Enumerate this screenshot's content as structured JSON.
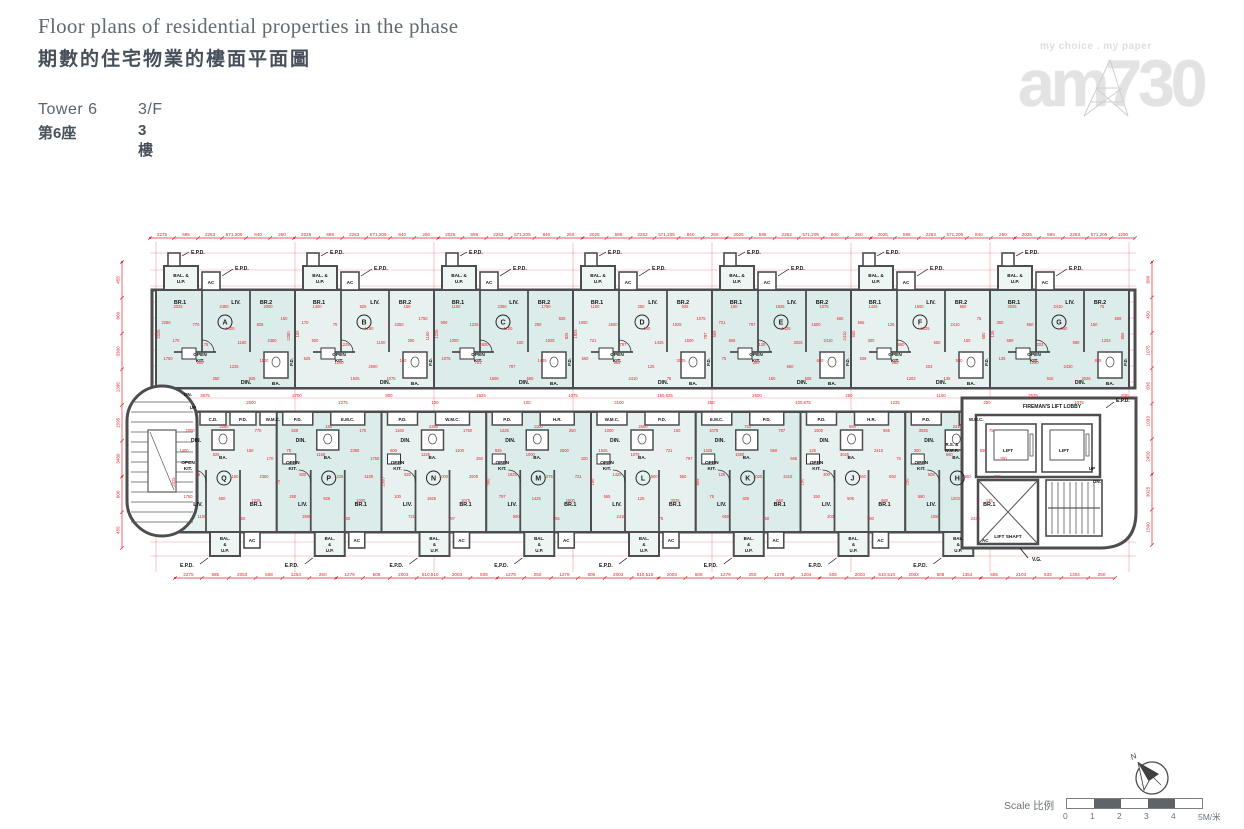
{
  "header": {
    "title_en": "Floor plans of residential properties in the phase",
    "title_zh": "期數的住宅物業的樓面平面圖",
    "tower_en": "Tower 6",
    "tower_zh": "第6座",
    "floor_en": "3/F",
    "floor_zh": "3樓"
  },
  "logo": {
    "tagline": "my choice . my paper",
    "brand": "am730"
  },
  "scale_bar": {
    "label": "Scale 比例",
    "ticks": [
      "0",
      "1",
      "2",
      "3",
      "4",
      "5M/米"
    ]
  },
  "compass": {
    "north": "N"
  },
  "colors": {
    "dim_red": "#e8232d",
    "wall": "#4d4d50",
    "room_fill": "#dcecea",
    "room_fill_alt": "#e7f2f0",
    "balcony_fill": "#eef6f4",
    "ink": "#141414",
    "tread": "#5a5a5c",
    "scale_dark": "#5f6468"
  },
  "plan": {
    "top_units": [
      "A",
      "B",
      "C",
      "D",
      "E",
      "F",
      "G"
    ],
    "bottom_units": [
      "Q",
      "P",
      "N",
      "M",
      "L",
      "K",
      "J",
      "H"
    ],
    "room_labels": {
      "br1": "BR.1",
      "br2": "BR.2",
      "liv": "LIV.",
      "din": "DIN.",
      "kit1": "OPEN",
      "kit2": "KIT.",
      "ba": "BA.",
      "bal1": "BAL. &",
      "bal2": "U.P.",
      "bal_s1": "BAL.",
      "bal_s2": "&",
      "bal_s3": "U.P.",
      "ac": "AC",
      "epd": "E.P.D.",
      "pd": "P.D."
    },
    "service_labels": {
      "cd": "C.D.",
      "wmc": "W.M.C.",
      "emc": "E.M.C.",
      "hr": "H.R.",
      "rs1": "R.S. &",
      "rs2": "W.M.R.",
      "up": "UP",
      "dn": "DN.",
      "vg": "V.G."
    },
    "core_labels": {
      "lobby": "FIREMAN'S LIFT LOBBY",
      "lift": "LIFT",
      "shaft": "LIFT SHAFT"
    },
    "left_service": [
      "C.D.",
      "P.D.",
      "W.M.C."
    ],
    "bottom_service_sequence": [
      "P.D.",
      "W.M.C.",
      "P.D.",
      "E.M.C.",
      "P.D.",
      "W.M.C.",
      "P.D.",
      "H.R.",
      "W.M.C.",
      "P.D.",
      "E.M.C.",
      "P.D.",
      "P.D.",
      "H.R."
    ],
    "dims": {
      "top": [
        "2275",
        "585",
        "2253",
        "571,205",
        "840",
        "250",
        "2025",
        "585",
        "2253",
        "571,205",
        "840",
        "250",
        "2025",
        "585",
        "2253",
        "571,205",
        "840",
        "250",
        "2025",
        "585",
        "2253",
        "571,205",
        "840",
        "250",
        "2025",
        "585",
        "2253",
        "571,205",
        "840",
        "250",
        "2025",
        "585",
        "2253",
        "571,205",
        "840",
        "250",
        "2025",
        "585",
        "2253",
        "571,205",
        "1290"
      ],
      "bottom": [
        "2275",
        "585",
        "2053",
        "508",
        "1254",
        "250",
        "1279",
        "508",
        "2003",
        "510,510",
        "2003",
        "508",
        "1279",
        "250",
        "1279",
        "508",
        "2003",
        "510,510",
        "2003",
        "508",
        "1279",
        "250",
        "1279",
        "1204",
        "508",
        "2003",
        "510,510",
        "2003",
        "508",
        "1354",
        "585",
        "2103",
        "533",
        "1304",
        "250"
      ],
      "left": [
        "455",
        "860",
        "3300",
        "1395",
        "1595",
        "3480",
        "600",
        "455"
      ],
      "right": [
        "890",
        "450",
        "1075",
        "835",
        "1033",
        "2450",
        "3025",
        "1500"
      ],
      "corridor": [
        "3675",
        "2600",
        "2700",
        "2275",
        "800",
        "100",
        "1925",
        "100",
        "1075",
        "3100",
        "150,825",
        "250",
        "2600",
        "100,675",
        "250",
        "1225",
        "1100",
        "250",
        "2575",
        "1075",
        "835"
      ],
      "interior": [
        "2025",
        "2450",
        "2000",
        "2280",
        "770",
        "1400",
        "825",
        "150",
        "170",
        "75",
        "1160",
        "2350",
        "1750",
        "600",
        "1225",
        "1100",
        "250",
        "925",
        "1000",
        "2600",
        "100",
        "1925",
        "1075",
        "721",
        "797",
        "1425",
        "1500",
        "560",
        "565",
        "125",
        "3025",
        "2410",
        "75",
        "300",
        "660",
        "650",
        "150",
        "508",
        "680",
        "203",
        "580",
        "1203",
        "135",
        "1050",
        "2430",
        "855",
        "910"
      ]
    }
  }
}
